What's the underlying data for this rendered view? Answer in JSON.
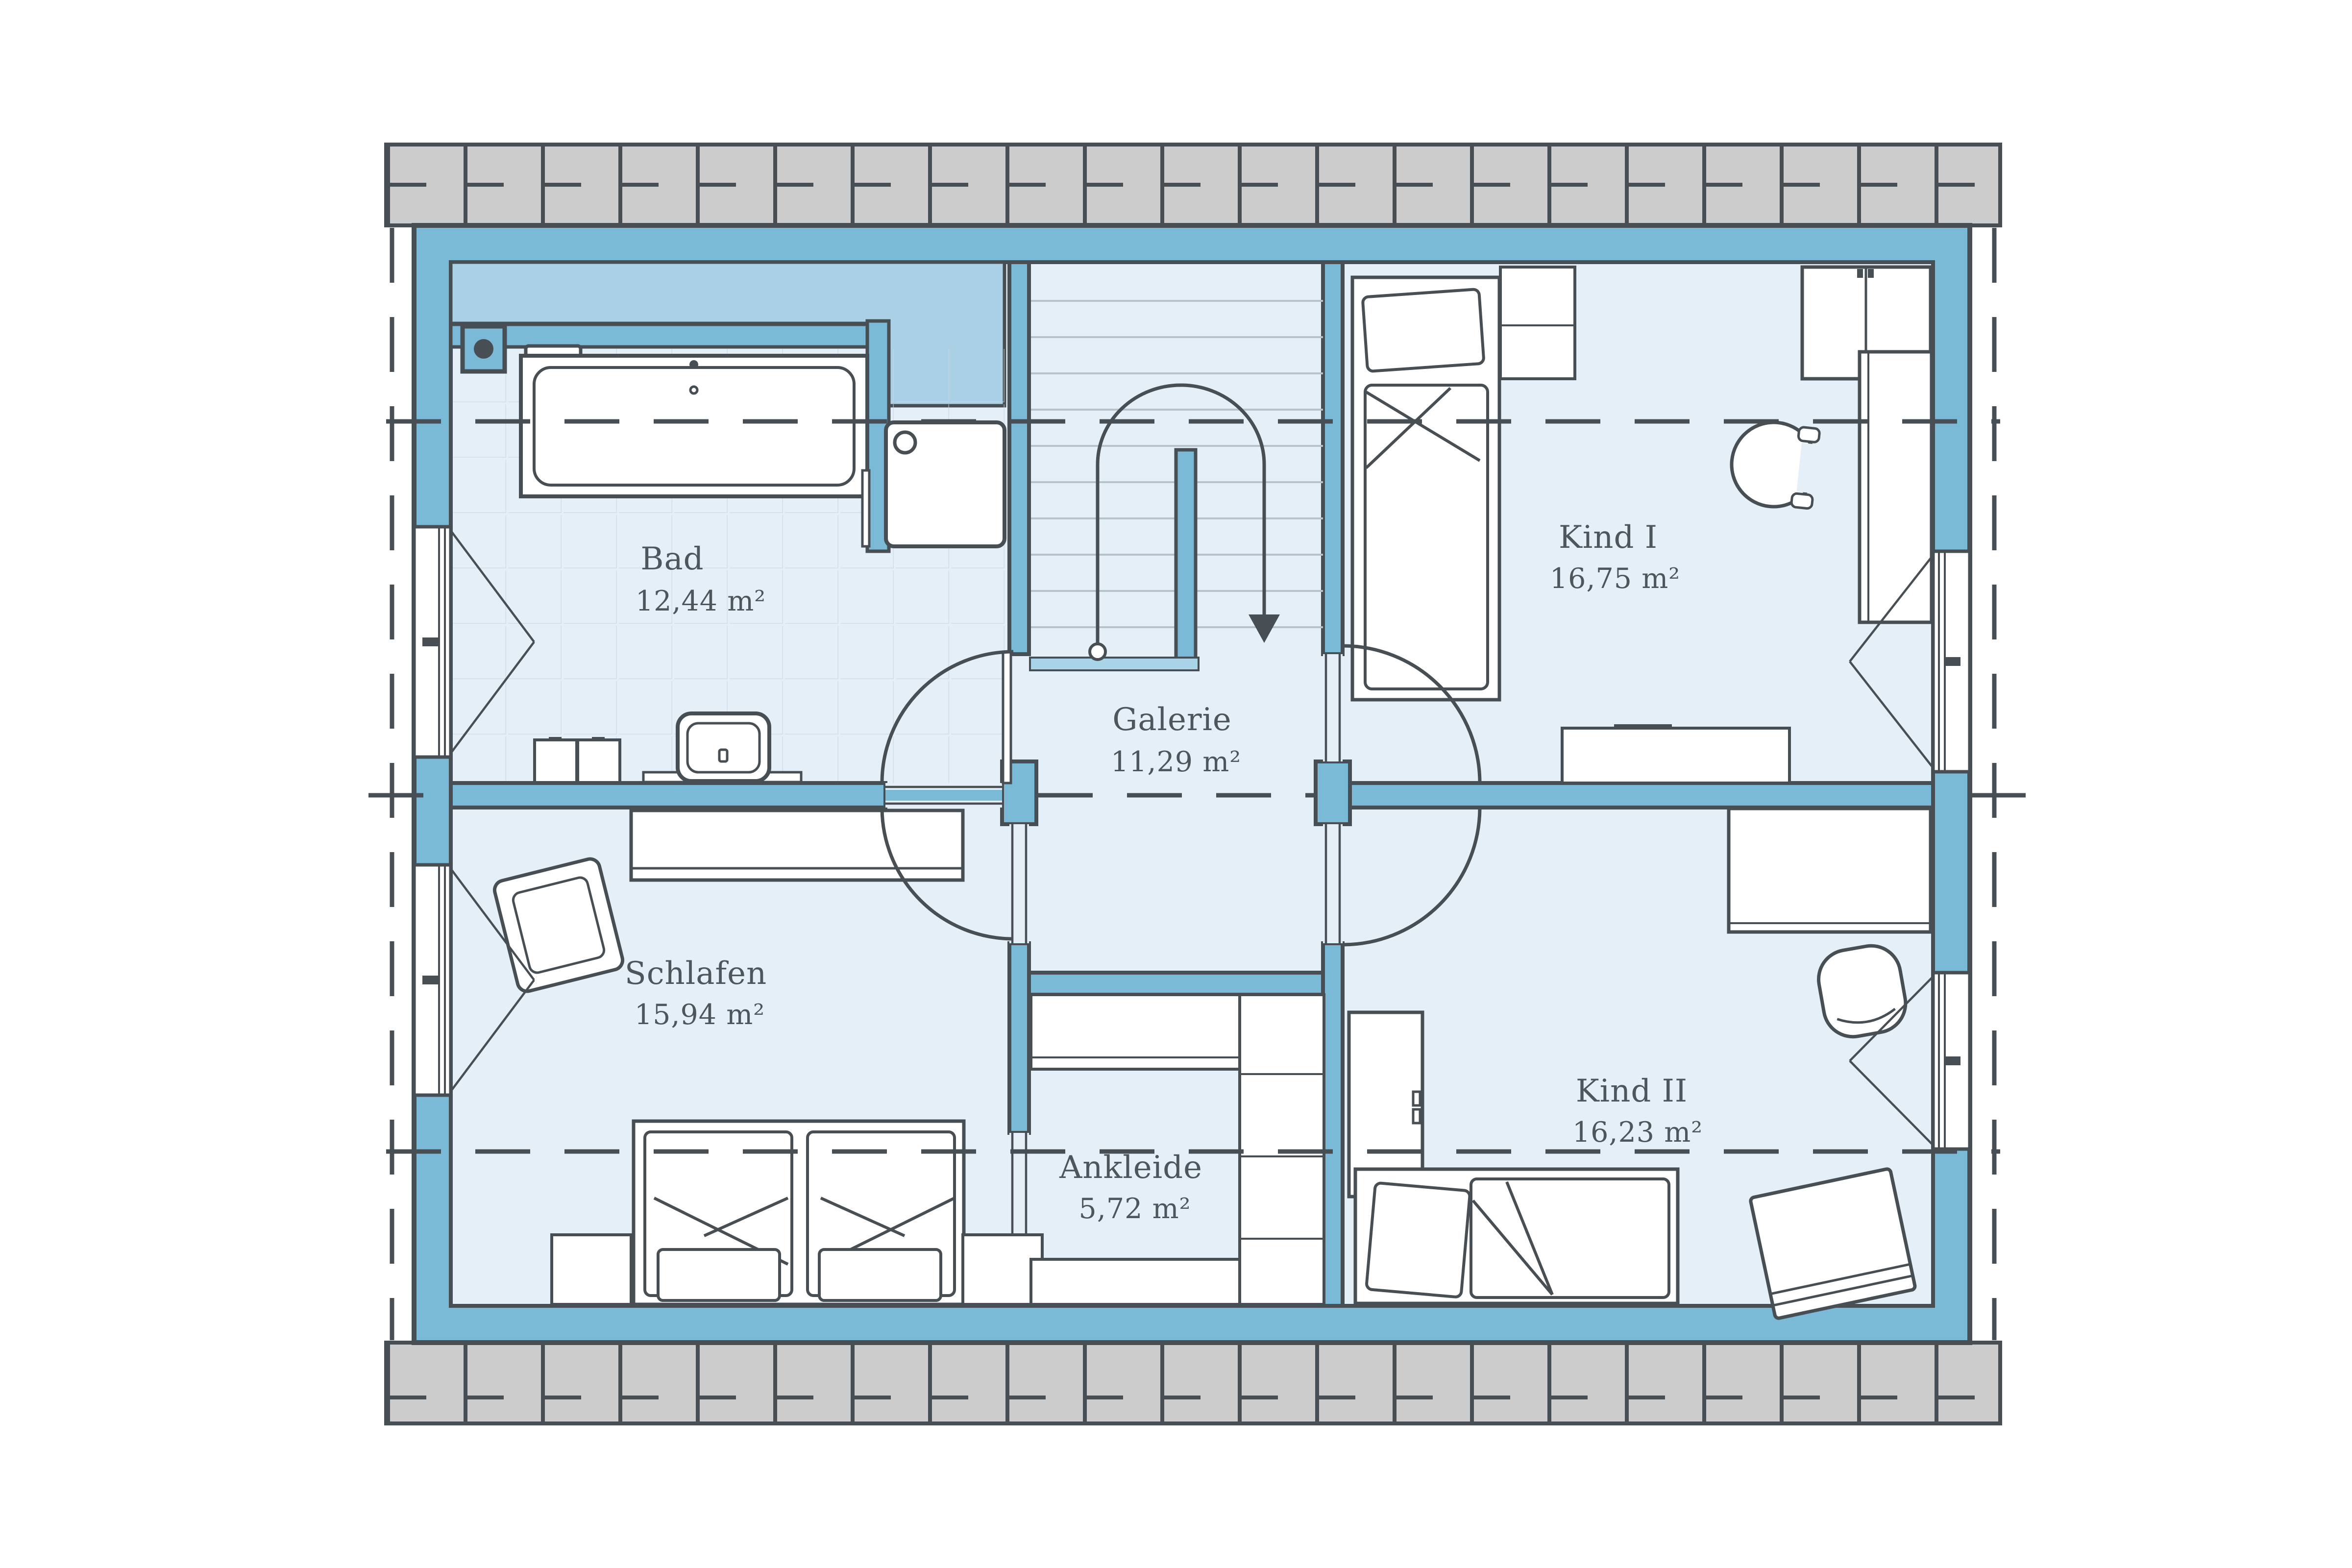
{
  "plan": {
    "type": "floor-plan",
    "rooms": [
      {
        "key": "bad",
        "name": "Bad",
        "area": "12,44 m²"
      },
      {
        "key": "galerie",
        "name": "Galerie",
        "area": "11,29 m²"
      },
      {
        "key": "kind1",
        "name": "Kind I",
        "area": "16,75 m²"
      },
      {
        "key": "schlafen",
        "name": "Schlafen",
        "area": "15,94 m²"
      },
      {
        "key": "ankleide",
        "name": "Ankleide",
        "area": "5,72 m²"
      },
      {
        "key": "kind2",
        "name": "Kind II",
        "area": "16,23 m²"
      }
    ],
    "icons": {
      "stair_arrow": "stairs-direction-down-arrow",
      "window_symbol": "casement-window-triangle",
      "door_symbol": "door-swing-arc"
    },
    "colors": {
      "wall_fill": "#7bbad6",
      "low_headroom_fill": "#a9d0e4",
      "floor_fill": "#e5eff7",
      "roof_hatch_fill": "#cccccc",
      "outline": "#474f54",
      "label_text": "#4d565c",
      "stair_tread": "#b7c3cb",
      "stair_landing": "#a9d3e6"
    }
  }
}
